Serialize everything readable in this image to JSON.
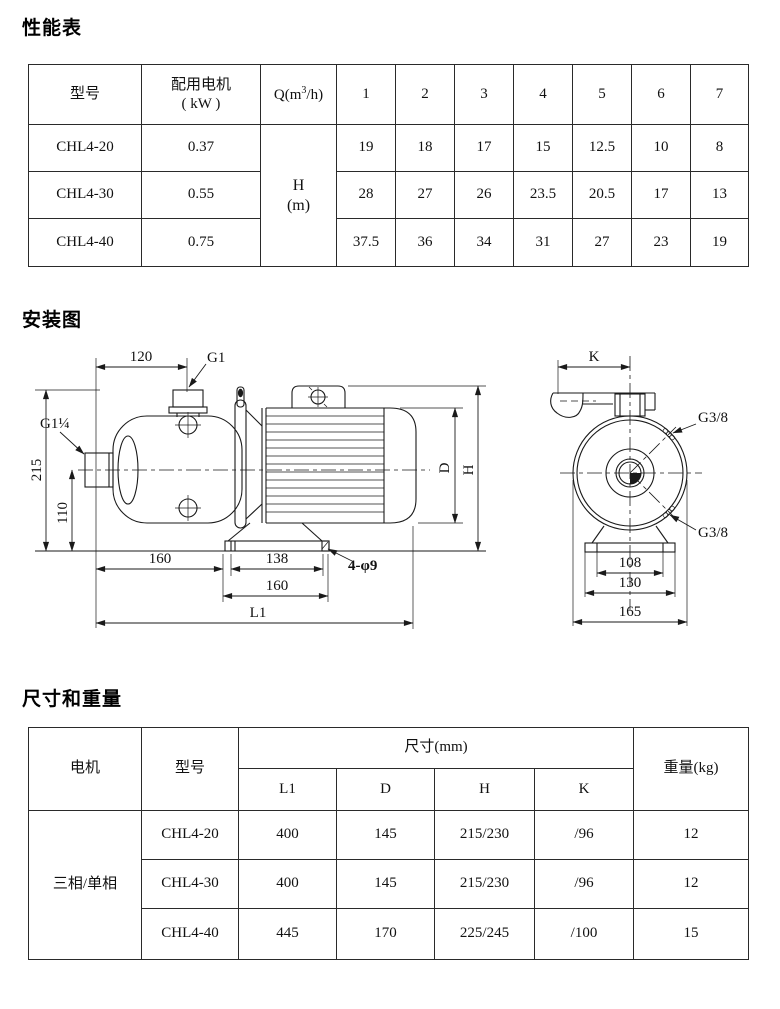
{
  "sections": {
    "performance": "性能表",
    "installation": "安装图",
    "dimensions": "尺寸和重量"
  },
  "perf": {
    "col_model": "型号",
    "col_motor_line1": "配用电机",
    "col_motor_line2": "( kW )",
    "q_pre": "Q(m",
    "q_sup": "3",
    "q_post": "/h)",
    "flow_cols": [
      "1",
      "2",
      "3",
      "4",
      "5",
      "6",
      "7"
    ],
    "h_line1": "H",
    "h_line2": "(m)",
    "rows": [
      {
        "model": "CHL4-20",
        "power": "0.37",
        "values": [
          "19",
          "18",
          "17",
          "15",
          "12.5",
          "10",
          "8"
        ]
      },
      {
        "model": "CHL4-30",
        "power": "0.55",
        "values": [
          "28",
          "27",
          "26",
          "23.5",
          "20.5",
          "17",
          "13"
        ]
      },
      {
        "model": "CHL4-40",
        "power": "0.75",
        "values": [
          "37.5",
          "36",
          "34",
          "31",
          "27",
          "23",
          "19"
        ]
      }
    ]
  },
  "dims": {
    "col_motor": "电机",
    "col_model": "型号",
    "col_size": "尺寸(mm)",
    "col_weight": "重量(kg)",
    "sub_cols": [
      "L1",
      "D",
      "H",
      "K"
    ],
    "motor_type": "三相/单相",
    "rows": [
      {
        "model": "CHL4-20",
        "l1": "400",
        "d": "145",
        "h": "215/230",
        "k": "/96",
        "weight": "12"
      },
      {
        "model": "CHL4-30",
        "l1": "400",
        "d": "145",
        "h": "215/230",
        "k": "/96",
        "weight": "12"
      },
      {
        "model": "CHL4-40",
        "l1": "445",
        "d": "170",
        "h": "225/245",
        "k": "/100",
        "weight": "15"
      }
    ]
  },
  "side_view": {
    "dim_top": "120",
    "port_top": "G1",
    "port_suction": "G1¼",
    "dim_height_total": "215",
    "dim_height_center": "110",
    "dim_foot_left": "160",
    "dim_holes": "138",
    "dim_foot": "160",
    "dim_length": "L1",
    "label_holes": "4-φ9",
    "dim_d": "D",
    "dim_h": "H"
  },
  "front_view": {
    "dim_k": "K",
    "port_top_label": "G3/8",
    "port_bottom_label": "G3/8",
    "dim_inner": "108",
    "dim_mid": "130",
    "dim_outer": "165"
  }
}
